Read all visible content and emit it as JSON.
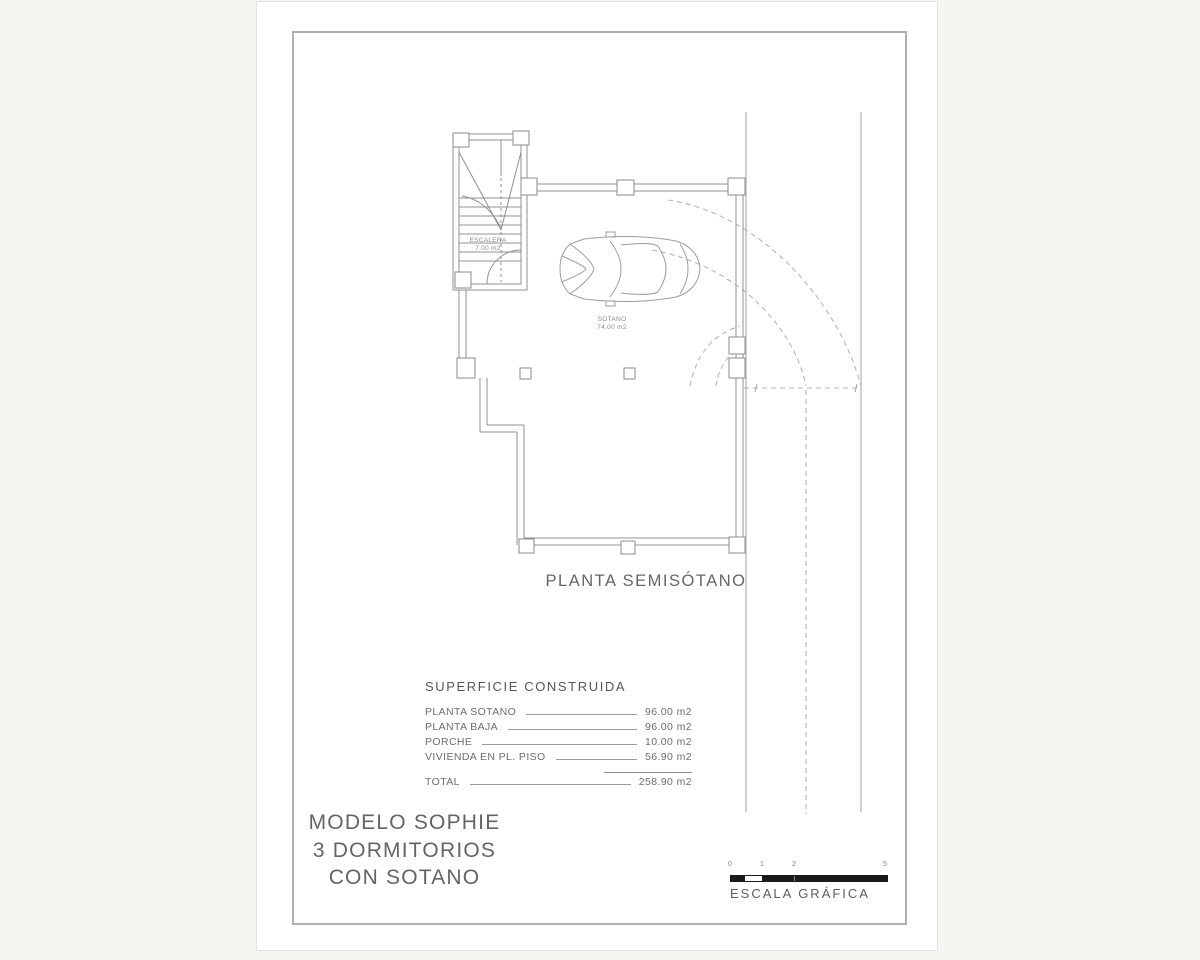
{
  "colors": {
    "background": "#f5f5f1",
    "paper": "#ffffff",
    "frame_border": "#b0b0ac",
    "wall_line": "#90908c",
    "dashed_line": "#b5b5b1",
    "text_gray": "#646461",
    "scale_bar": "#1b1b19"
  },
  "plan": {
    "title": "PLANTA SEMISÓTANO",
    "stair_label": {
      "line1": "ESCALERA",
      "line2": "7.00 m2"
    },
    "room_label": {
      "line1": "SÓTANO",
      "line2": "74.00 m2"
    }
  },
  "areas_table": {
    "heading": "SUPERFICIE CONSTRUIDA",
    "rows": [
      {
        "label": "PLANTA SOTANO",
        "value": "96.00 m2"
      },
      {
        "label": "PLANTA BAJA",
        "value": "96.00 m2"
      },
      {
        "label": "PORCHE",
        "value": "10.00 m2"
      },
      {
        "label": "VIVIENDA EN PL. PISO",
        "value": "56.90 m2"
      }
    ],
    "total": {
      "label": "TOTAL",
      "value": "258.90 m2"
    }
  },
  "model": {
    "line1": "MODELO SOPHIE",
    "line2": "3 DORMITORIOS",
    "line3": "CON SOTANO"
  },
  "scale": {
    "ticks": [
      "0",
      "1",
      "2",
      "5"
    ],
    "caption": "ESCALA GRÁFICA"
  }
}
